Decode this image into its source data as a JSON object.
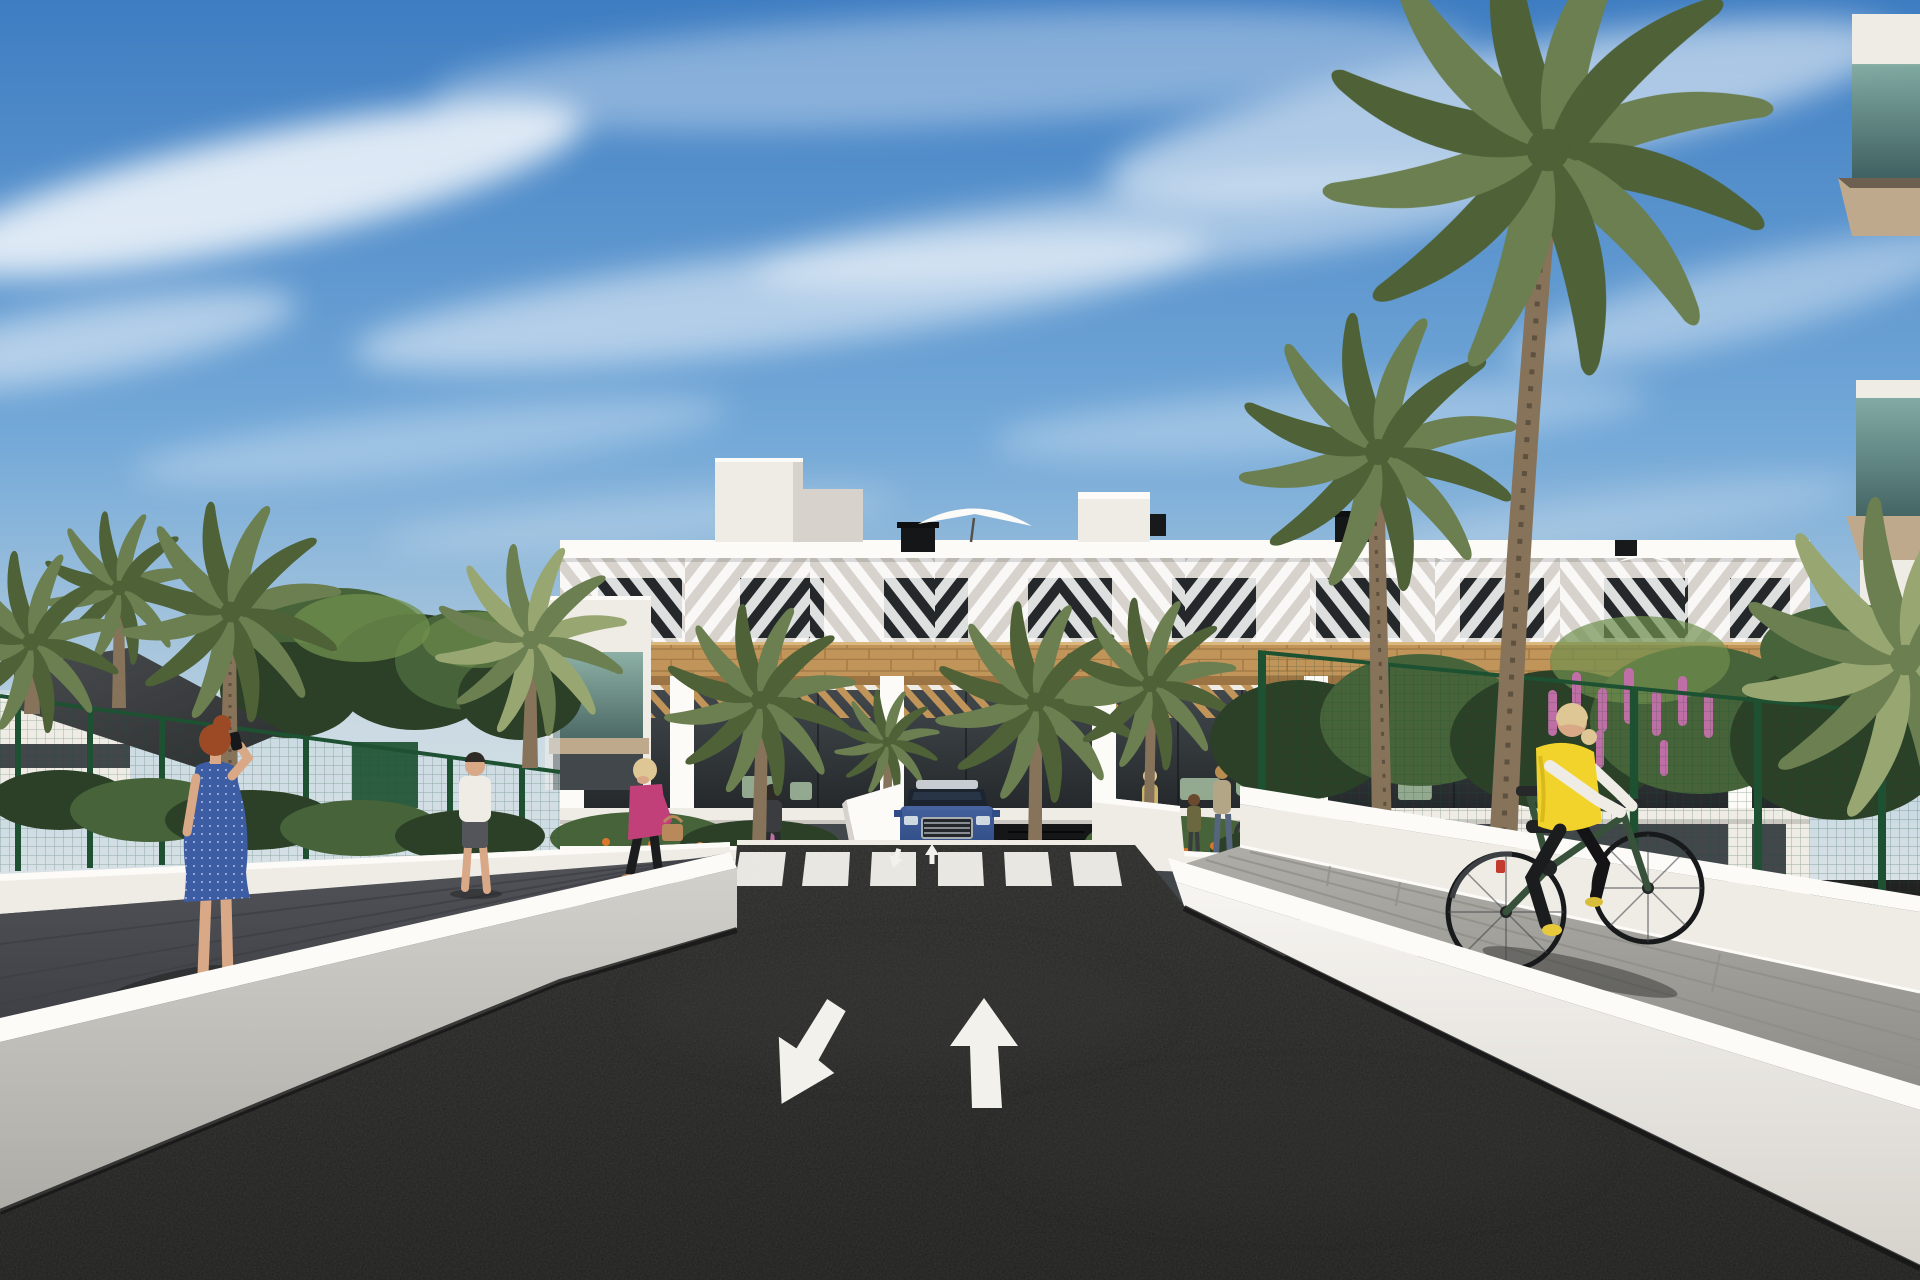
{
  "scene": {
    "alt": "3D architectural rendering of a modern white three-storey apartment complex with timber pergola balconies, tall palm trees and gardens; a dark asphalt access road with two painted lane arrows and a zebra crosswalk leads to an underground car park where a dark blue SUV is exiting; a red-haired woman in a blue dress talks on her phone on the shaded left path, a blonde woman in a pink jacket walks past flower beds, and a woman in a yellow vest cycles along the sunlit right walkway beside a green mesh fence under a blue sky with wispy clouds.",
    "labels": {
      "sky": "Blue sky with wispy cirrus clouds",
      "building": "White three-storey apartment block with louvred roof level, timber band and pergola balconies",
      "left_building": "Left building edge with green glass balcony",
      "right_building": "Foreground building corner with green glass balconies",
      "shade_sail": "Dark shade sail over the left courtyard",
      "left_fence": "Green mesh garden fence on the left",
      "right_fence": "Green mesh garden fence on the right",
      "palms": "Tall palm trees around the complex",
      "garden": "Planted beds with orange and pink flowers",
      "road": "Dark asphalt access road between white retaining walls",
      "crosswalk": "White zebra pedestrian crossing",
      "arrow_up": "White lane arrow pointing away from the viewer",
      "arrow_down": "White lane arrow pointing toward the viewer",
      "car": "Dark blue SUV at the car park ramp",
      "garage": "Underground car park entrance",
      "woman_phone": "Red-haired woman in a blue dress talking on the phone",
      "man_walking": "Man in a white T-shirt walking along the fence",
      "woman_pink": "Blonde woman in a pink jacket carrying a tan handbag",
      "pedestrians": "Residents with bicycles near the bike racks",
      "cyclist": "Woman in a yellow vest riding a bicycle",
      "left_wall": "White retaining wall on the left",
      "right_wall": "White retaining wall on the right",
      "left_path": "Shaded pedestrian path on the left",
      "right_path": "Sunlit paved walkway on the right"
    }
  },
  "palette": {
    "sky_top": "#3e7dc2",
    "sky_mid": "#74a9d8",
    "sky_low": "#b9d0df",
    "sky_haze": "#d9e2e6",
    "cloud": "#ffffff",
    "wall_bright": "#fcfbf8",
    "wall_light": "#efece6",
    "wall_mid": "#d7d3cc",
    "wall_dark": "#b3b0aa",
    "wood": "#c19459",
    "wood_dark": "#9c7443",
    "wood_light": "#dab87e",
    "glass_dark": "#24282b",
    "glass_mid": "#41474b",
    "teal_light": "#84aba0",
    "teal_dark": "#3f5f5b",
    "asphalt": "#2b2b2a",
    "asphalt_deep": "#1f1f1e",
    "marking": "#f2f1ec",
    "path_shade": "#515358",
    "path_shade_deep": "#3e4045",
    "path_sun": "#aeada7",
    "path_sun_deep": "#8d8c86",
    "fence": "#1d5132",
    "fol_dark": "#2b4026",
    "fol_mid": "#466339",
    "fol_light": "#70904e",
    "palm": "#6c7f51",
    "palm_dark": "#4e6137",
    "palm_pale": "#98a771",
    "trunk": "#86735a",
    "trunk_dark": "#5e513f",
    "sail_light": "#494c4e",
    "sail_dark": "#2d2f31",
    "car_top": "#44609c",
    "car_body": "#2e4c86",
    "car_dark": "#1c2128",
    "chrome": "#a8adb2",
    "skin": "#d9a987",
    "hair_red": "#9c4a26",
    "hair_blonde": "#dfc795",
    "hair_dark": "#2e2a26",
    "dress_blue": "#3c5ca4",
    "dress_dot": "#cdd6ee",
    "pink": "#c2407a",
    "vest": "#f2d32b",
    "white_cloth": "#efece5",
    "black_cloth": "#1b1c1e",
    "bag": "#b9895c",
    "flw_pink": "#c06fa6",
    "flw_orange": "#d9782c",
    "shadow": "#191918",
    "slab_tan": "#bfa98c",
    "denim": "#55657c"
  }
}
